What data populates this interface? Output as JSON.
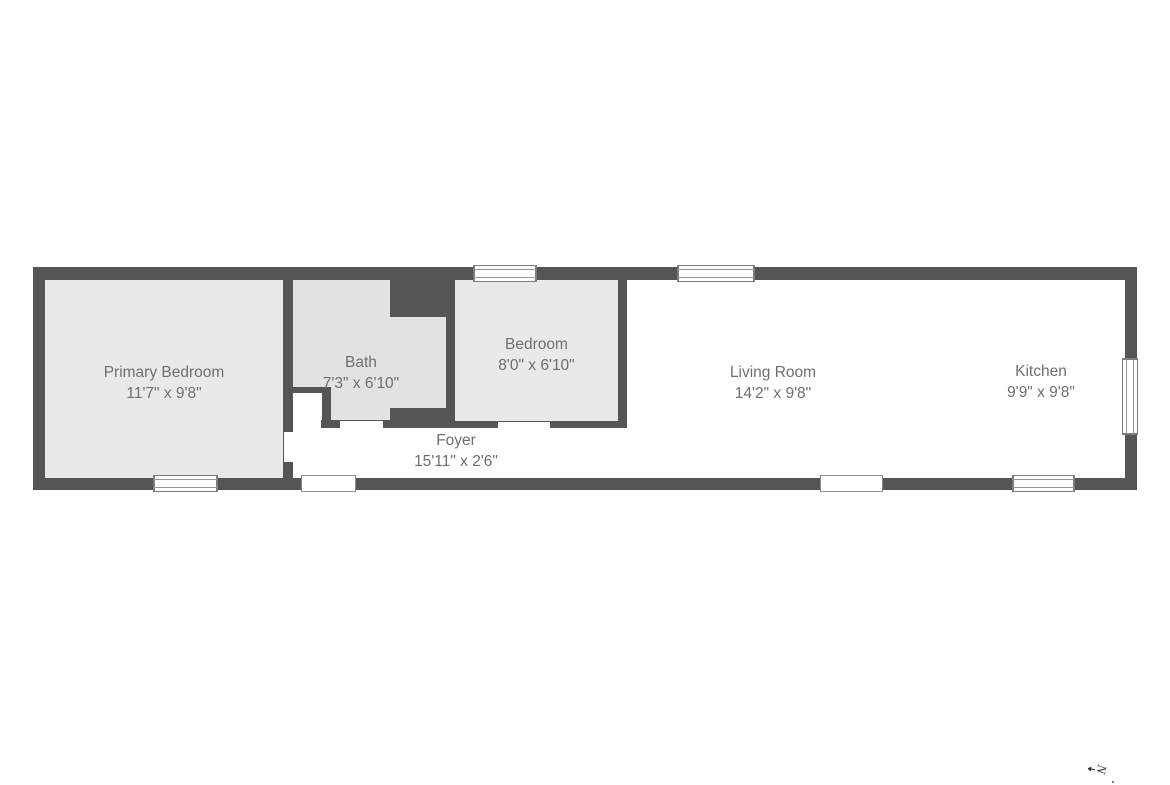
{
  "page": {
    "background": "#ffffff"
  },
  "floorplan": {
    "colors": {
      "wall": "#555555",
      "bedroom_floor": "#e9e9e9",
      "bath_floor": "#e2e2e2",
      "open_floor": "#ffffff",
      "label_text": "#6f6f6f"
    },
    "rooms": [
      {
        "name": "Primary Bedroom",
        "dims": "11'7\" x 9'8\""
      },
      {
        "name": "Bath",
        "dims": "7'3\" x 6'10\""
      },
      {
        "name": "Bedroom",
        "dims": "8'0\" x 6'10\""
      },
      {
        "name": "Living Room",
        "dims": "14'2\" x 9'8\""
      },
      {
        "name": "Kitchen",
        "dims": "9'9\" x 9'8\""
      },
      {
        "name": "Foyer",
        "dims": "15'11\" x 2'6\""
      }
    ],
    "compass": {
      "label": "N"
    }
  }
}
